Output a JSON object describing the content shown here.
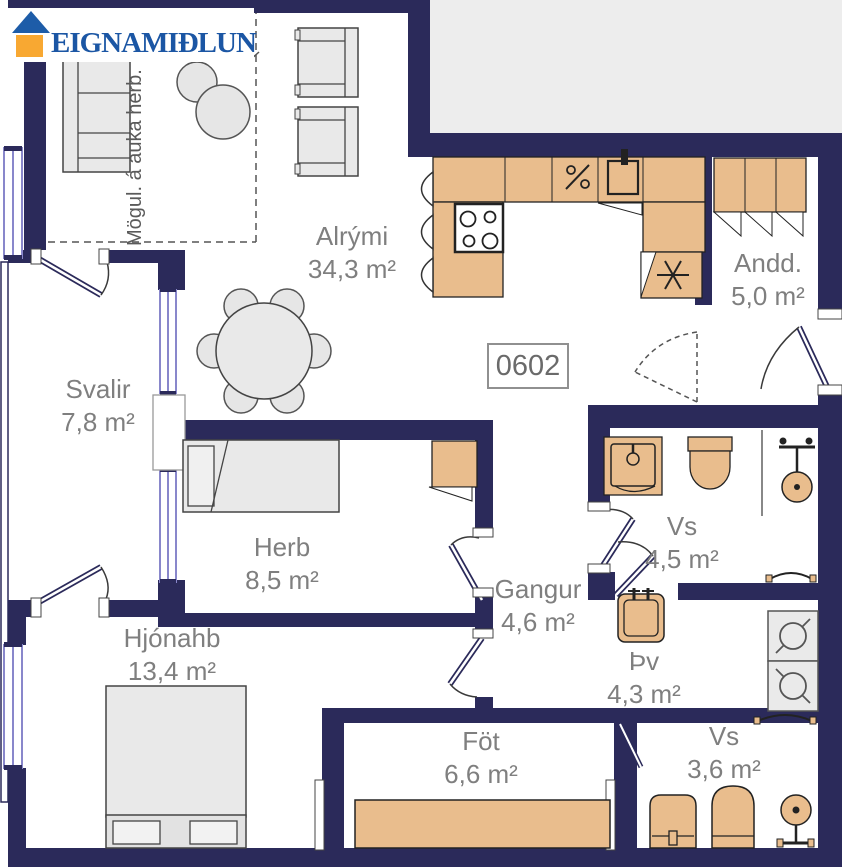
{
  "brand": {
    "name": "EIGNAMIÐLUN"
  },
  "unit_number": "0602",
  "annotation": "Mögul. á auka herb.",
  "rooms": [
    {
      "name": "Alrými",
      "area": "34,3 m²"
    },
    {
      "name": "Andd.",
      "area": "5,0 m²"
    },
    {
      "name": "Svalir",
      "area": "7,8 m²"
    },
    {
      "name": "Herb",
      "area": "8,5 m²"
    },
    {
      "name": "Gangur",
      "area": "4,6 m²"
    },
    {
      "name": "Vs",
      "area": "4,5 m²"
    },
    {
      "name": "Hjónahb",
      "area": "13,4 m²"
    },
    {
      "name": "Þv",
      "area": "4,3 m²"
    },
    {
      "name": "Föt",
      "area": "6,6 m²"
    },
    {
      "name": "Vs",
      "area": "3,6 m²"
    }
  ],
  "icons": {
    "house_logo": "roof-triangle-over-orange-square",
    "freezer": "six-spoke-asterisk",
    "dishwasher": "percent-slash",
    "washer_dryer": "circle-with-rotation-ticks"
  },
  "colors": {
    "wall": "#2b2a5a",
    "fixture_tan": "#e9bd8d",
    "furniture_fill": "#e9e9e9",
    "window": "#8987cb",
    "label_text": "#7f7f7f",
    "logo_blue": "#1d5ca8",
    "logo_orange": "#f8a832",
    "logo_text": "#1b56a4",
    "exterior": "#ededed"
  }
}
